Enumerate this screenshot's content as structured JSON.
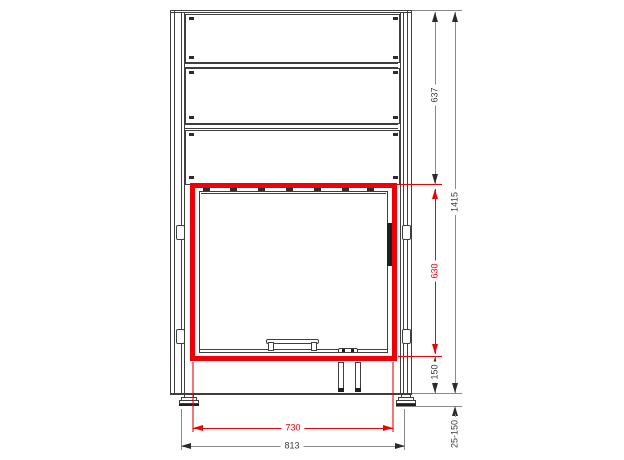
{
  "drawing": {
    "view": "technical front elevation of fireplace insert cabinet",
    "line_color": "#3f3f3f",
    "accent_color": "#ef0009",
    "background_color": "#ffffff"
  },
  "dimensions": {
    "upper_section_height": "637",
    "total_height": "1415",
    "opening_height": "630",
    "plinth_height": "150",
    "foot_adjust_range": "25-150",
    "opening_width": "730",
    "body_width": "813"
  }
}
